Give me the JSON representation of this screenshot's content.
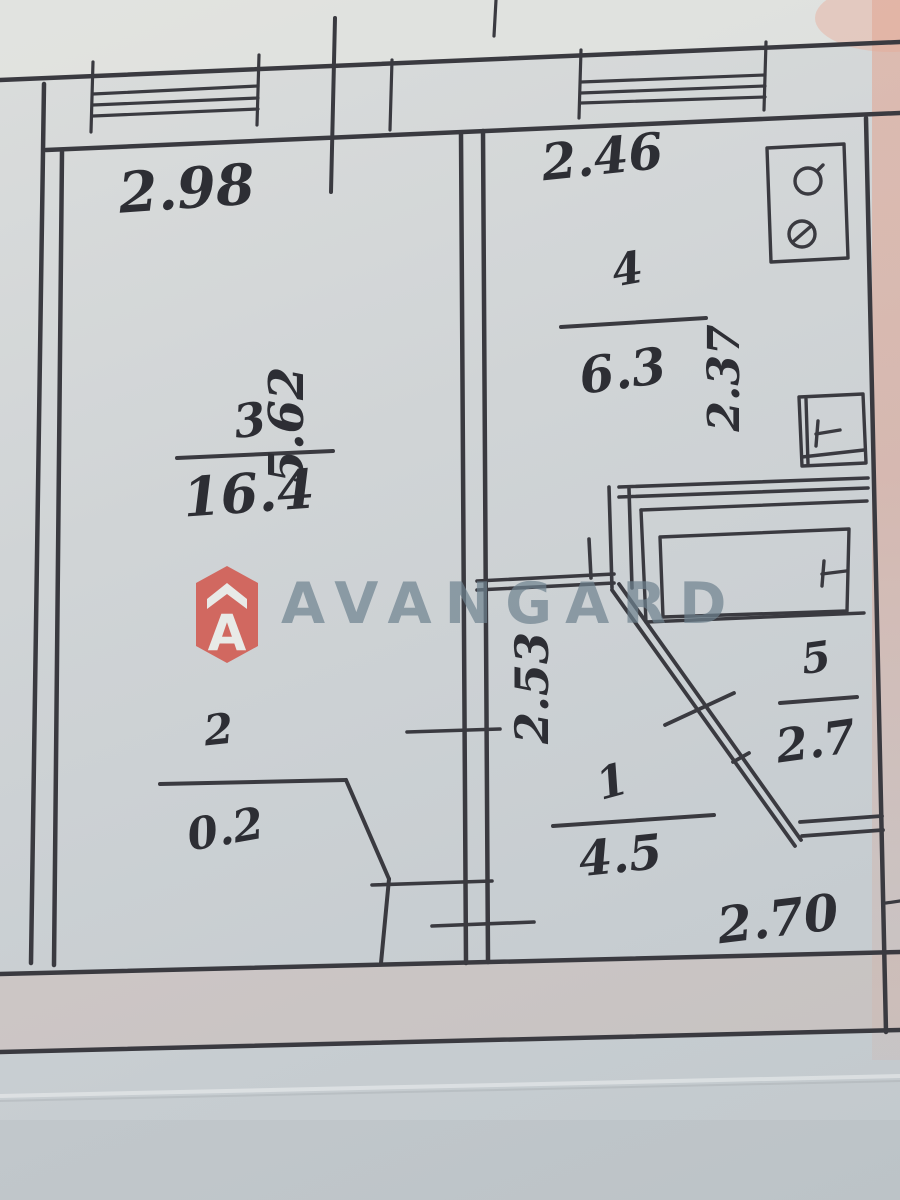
{
  "watermark": {
    "brand": "AVANGARD",
    "logo_letter": "A"
  },
  "rooms": {
    "living": {
      "number": "3",
      "area": "16.4"
    },
    "kitchen": {
      "number": "4",
      "area": "6.3"
    },
    "bath": {
      "number": "5",
      "area": "2.7"
    },
    "hall": {
      "number": "1",
      "area": "4.5"
    },
    "closet": {
      "number": "2",
      "area": "0.2"
    }
  },
  "dimensions": {
    "top_left": "2.98",
    "top_right": "2.46",
    "left_side": "5.62",
    "kitchen_right": "2.37",
    "hall_center": "2.53",
    "bottom_right": "2.70"
  },
  "colors": {
    "ink": "#3a3a40",
    "paper": "#ccd1d4",
    "paper_edge_pink": "#dca795",
    "watermark_text": "#6d8290",
    "logo_red": "#d25a50"
  }
}
